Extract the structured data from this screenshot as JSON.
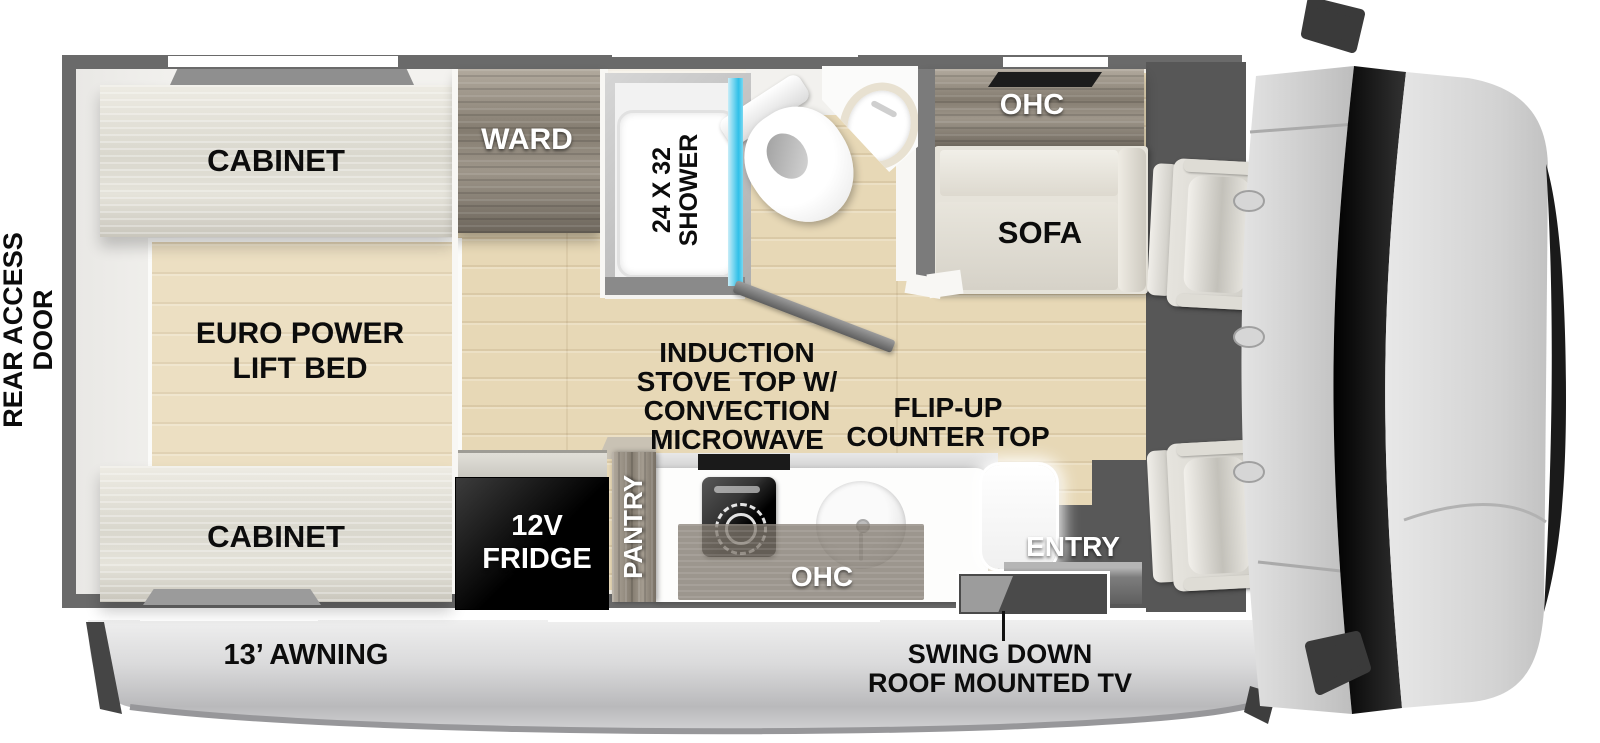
{
  "diagram": {
    "type": "rv-motorhome-floorplan-top-view",
    "colors": {
      "wall": "#6a6a6a",
      "floor_wood": "#e7d8b6",
      "cabinet_wood": "#dcdacf",
      "dark_wood": "#8a8275",
      "shower_glass": "#3cc4ea",
      "appliance_black": "#0d0d0d",
      "awning_gray": "#cdcdcf",
      "cab_dark": "#575757",
      "label_black": "#0c0c0c",
      "label_white": "#ffffff"
    }
  },
  "labels": {
    "rear_access_door": [
      "REAR ACCESS",
      "DOOR"
    ],
    "cabinet_top": "CABINET",
    "bed": [
      "EURO POWER",
      "LIFT BED"
    ],
    "cabinet_bottom": "CABINET",
    "ward": "WARD",
    "shower": [
      "24 X 32",
      "SHOWER"
    ],
    "ohc_sofa": "OHC",
    "sofa": "SOFA",
    "stove": [
      "INDUCTION",
      "STOVE TOP W/",
      "CONVECTION",
      "MICROWAVE"
    ],
    "flip_up": [
      "FLIP-UP",
      "COUNTER TOP"
    ],
    "fridge": [
      "12V",
      "FRIDGE"
    ],
    "pantry": "PANTRY",
    "ohc_kitchen": "OHC",
    "entry": "ENTRY",
    "awning": "13’ AWNING",
    "tv": [
      "SWING DOWN",
      "ROOF MOUNTED TV"
    ]
  }
}
